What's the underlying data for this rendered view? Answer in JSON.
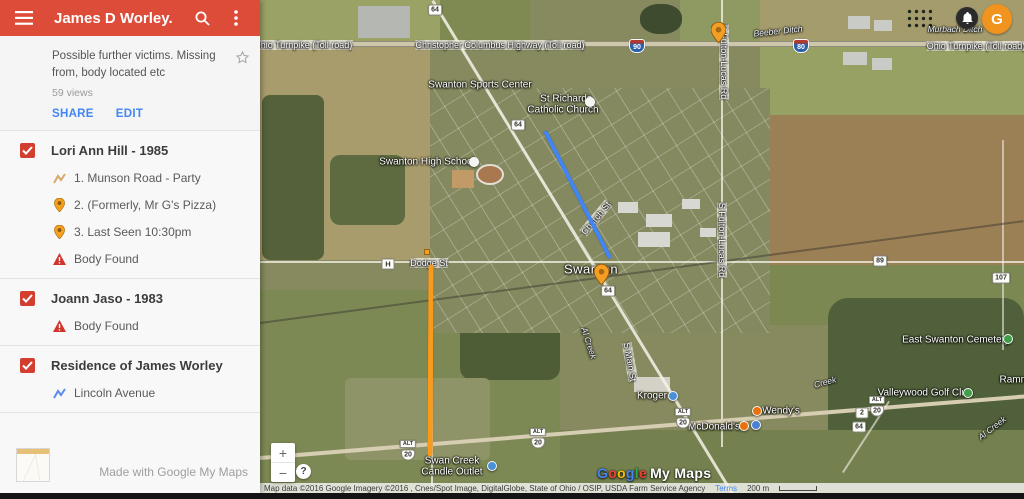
{
  "header": {
    "title": "James D Worley.",
    "bg_color": "#dd4b39"
  },
  "description": {
    "text": "Possible further victims. Missing from, body located etc",
    "views": "59 views",
    "share_label": "SHARE",
    "edit_label": "EDIT"
  },
  "layers": [
    {
      "title": "Lori Ann Hill - 1985",
      "checked": true,
      "items": [
        {
          "icon": "route-line-tan",
          "label": "1. Munson Road - Party"
        },
        {
          "icon": "pin",
          "label": "2. (Formerly, Mr G's Pizza)"
        },
        {
          "icon": "pin",
          "label": "3. Last Seen 10:30pm"
        },
        {
          "icon": "warning",
          "label": "Body Found"
        }
      ]
    },
    {
      "title": "Joann Jaso - 1983",
      "checked": true,
      "items": [
        {
          "icon": "warning",
          "label": "Body Found"
        }
      ]
    },
    {
      "title": "Residence of James Worley",
      "checked": true,
      "items": [
        {
          "icon": "route-line-blue",
          "label": "Lincoln Avenue"
        }
      ]
    }
  ],
  "footer": {
    "made_with": "Made with Google My Maps"
  },
  "colors": {
    "checkbox_red": "#d23f31",
    "link_blue": "#4285f4",
    "pin_orange": "#F59E24",
    "avatar_orange": "#F0931F"
  },
  "map": {
    "controls": {
      "zoom_in": "+",
      "zoom_out": "−",
      "help": "?"
    },
    "account": {
      "initial": "G"
    },
    "attribution": {
      "text": "Map data ©2016 Google Imagery ©2016 , Cnes/Spot Image, DigitalGlobe, State of Ohio / OSIP, USDA Farm Service Agency",
      "terms": "Terms",
      "scale": "200 m"
    },
    "watermark": {
      "letters": [
        "G",
        "o",
        "o",
        "g",
        "l",
        "e"
      ],
      "letter_colors": [
        "#4285F4",
        "#EA4335",
        "#FBBC05",
        "#4285F4",
        "#34A853",
        "#EA4335"
      ],
      "suffix": "My Maps"
    },
    "labels": [
      {
        "text": "Ohio Turnpike (Toll road)",
        "x": 43,
        "y": 45,
        "cls": "road"
      },
      {
        "text": "Christopher Columbus Highway (Toll road)",
        "x": 240,
        "y": 45,
        "cls": "road"
      },
      {
        "text": "Ohio Turnpike (Toll road)",
        "x": 716,
        "y": 46,
        "cls": "road"
      },
      {
        "text": "Beeber Ditch",
        "x": 518,
        "y": 31,
        "cls": "water",
        "rot": -6
      },
      {
        "text": "Murbach Ditch",
        "x": 695,
        "y": 29,
        "cls": "water"
      },
      {
        "text": "Swanton Sports Center",
        "x": 220,
        "y": 85,
        "cls": "poi"
      },
      {
        "text": "St Richards",
        "x": 306,
        "y": 99,
        "cls": "poi"
      },
      {
        "text": "Catholic Church",
        "x": 303,
        "y": 110,
        "cls": "poi"
      },
      {
        "text": "Swanton High School",
        "x": 167,
        "y": 162,
        "cls": "poi"
      },
      {
        "text": "Church St",
        "x": 336,
        "y": 218,
        "cls": "road",
        "rot": -50
      },
      {
        "text": "S Fulton-Lucas Rd",
        "x": 464,
        "y": 62,
        "cls": "road",
        "rot": 90
      },
      {
        "text": "S Fulton-Lucas Rd",
        "x": 462,
        "y": 240,
        "cls": "road",
        "rot": 90
      },
      {
        "text": "Swanton",
        "x": 331,
        "y": 269,
        "cls": "city"
      },
      {
        "text": "Dodge St",
        "x": 169,
        "y": 263,
        "cls": "road"
      },
      {
        "text": "S Main St",
        "x": 370,
        "y": 362,
        "cls": "road",
        "rot": 80
      },
      {
        "text": "Al Creek",
        "x": 329,
        "y": 343,
        "cls": "water",
        "rot": 72
      },
      {
        "text": "Kroger",
        "x": 392,
        "y": 396,
        "cls": "poi"
      },
      {
        "text": "Wendy's",
        "x": 521,
        "y": 411,
        "cls": "poi"
      },
      {
        "text": "McDonald's",
        "x": 454,
        "y": 427,
        "cls": "poi"
      },
      {
        "text": "Swan Creek",
        "x": 192,
        "y": 461,
        "cls": "poi"
      },
      {
        "text": "Candle Outlet",
        "x": 192,
        "y": 472,
        "cls": "poi"
      },
      {
        "text": "East Swanton Cemetery",
        "x": 696,
        "y": 340,
        "cls": "poi"
      },
      {
        "text": "Valleywood Golf Club",
        "x": 665,
        "y": 393,
        "cls": "poi"
      },
      {
        "text": "Ramme",
        "x": 757,
        "y": 380,
        "cls": "poi"
      },
      {
        "text": "Al Creek",
        "x": 732,
        "y": 428,
        "cls": "water",
        "rot": -38
      },
      {
        "text": "Creek",
        "x": 565,
        "y": 382,
        "cls": "water",
        "rot": -15
      }
    ],
    "shields": [
      {
        "kind": "state",
        "text": "64",
        "x": 175,
        "y": 10
      },
      {
        "kind": "state",
        "text": "64",
        "x": 258,
        "y": 125
      },
      {
        "kind": "state",
        "text": "64",
        "x": 348,
        "y": 291
      },
      {
        "kind": "state",
        "text": "64",
        "x": 599,
        "y": 427
      },
      {
        "kind": "state",
        "text": "2",
        "x": 602,
        "y": 413
      },
      {
        "kind": "state",
        "text": "89",
        "x": 620,
        "y": 261
      },
      {
        "kind": "state",
        "text": "107",
        "x": 741,
        "y": 278
      },
      {
        "kind": "county",
        "text": "H",
        "x": 128,
        "y": 264
      },
      {
        "kind": "interstate",
        "text": "90",
        "x": 377,
        "y": 46
      },
      {
        "kind": "interstate",
        "text": "80",
        "x": 541,
        "y": 46
      },
      {
        "kind": "alt",
        "text": "ALT",
        "x": 148,
        "y": 444
      },
      {
        "kind": "us",
        "text": "20",
        "x": 148,
        "y": 455
      },
      {
        "kind": "alt",
        "text": "ALT",
        "x": 278,
        "y": 432
      },
      {
        "kind": "us",
        "text": "20",
        "x": 278,
        "y": 443
      },
      {
        "kind": "alt",
        "text": "ALT",
        "x": 423,
        "y": 412
      },
      {
        "kind": "us",
        "text": "20",
        "x": 423,
        "y": 423
      },
      {
        "kind": "alt",
        "text": "ALT",
        "x": 617,
        "y": 400
      },
      {
        "kind": "us",
        "text": "20",
        "x": 617,
        "y": 411
      }
    ],
    "pois": [
      {
        "name": "church-icon",
        "x": 330,
        "y": 102,
        "color": "#f4f4f0"
      },
      {
        "name": "school-icon",
        "x": 214,
        "y": 162,
        "color": "#f4f4f0"
      },
      {
        "name": "shopping-icon",
        "x": 413,
        "y": 396,
        "color": "#4a90d9"
      },
      {
        "name": "shopping-icon",
        "x": 232,
        "y": 466,
        "color": "#4a90d9"
      },
      {
        "name": "restaurant-icon",
        "x": 497,
        "y": 411,
        "color": "#e8710a"
      },
      {
        "name": "restaurant-icon",
        "x": 484,
        "y": 426,
        "color": "#e8710a"
      },
      {
        "name": "generic-poi-icon",
        "x": 496,
        "y": 425,
        "color": "#4a7fd6"
      },
      {
        "name": "cemetery-icon",
        "x": 748,
        "y": 339,
        "color": "#3f9e48"
      },
      {
        "name": "golf-icon",
        "x": 708,
        "y": 393,
        "color": "#3f9e48"
      }
    ],
    "pins": [
      {
        "x": 458,
        "y": 43
      },
      {
        "x": 341,
        "y": 285
      }
    ],
    "squares": [
      {
        "x": 167,
        "y": 252,
        "color": "#F59E24"
      }
    ],
    "lines": [
      {
        "name": "route-overlay-blue",
        "x1": 285,
        "y1": 131,
        "x2": 350,
        "y2": 258,
        "w": 4,
        "color": "#4285F4"
      },
      {
        "name": "route-overlay-orange",
        "x1": 171,
        "y1": 264,
        "x2": 170,
        "y2": 456,
        "w": 5,
        "color": "#F89A1C"
      }
    ]
  }
}
